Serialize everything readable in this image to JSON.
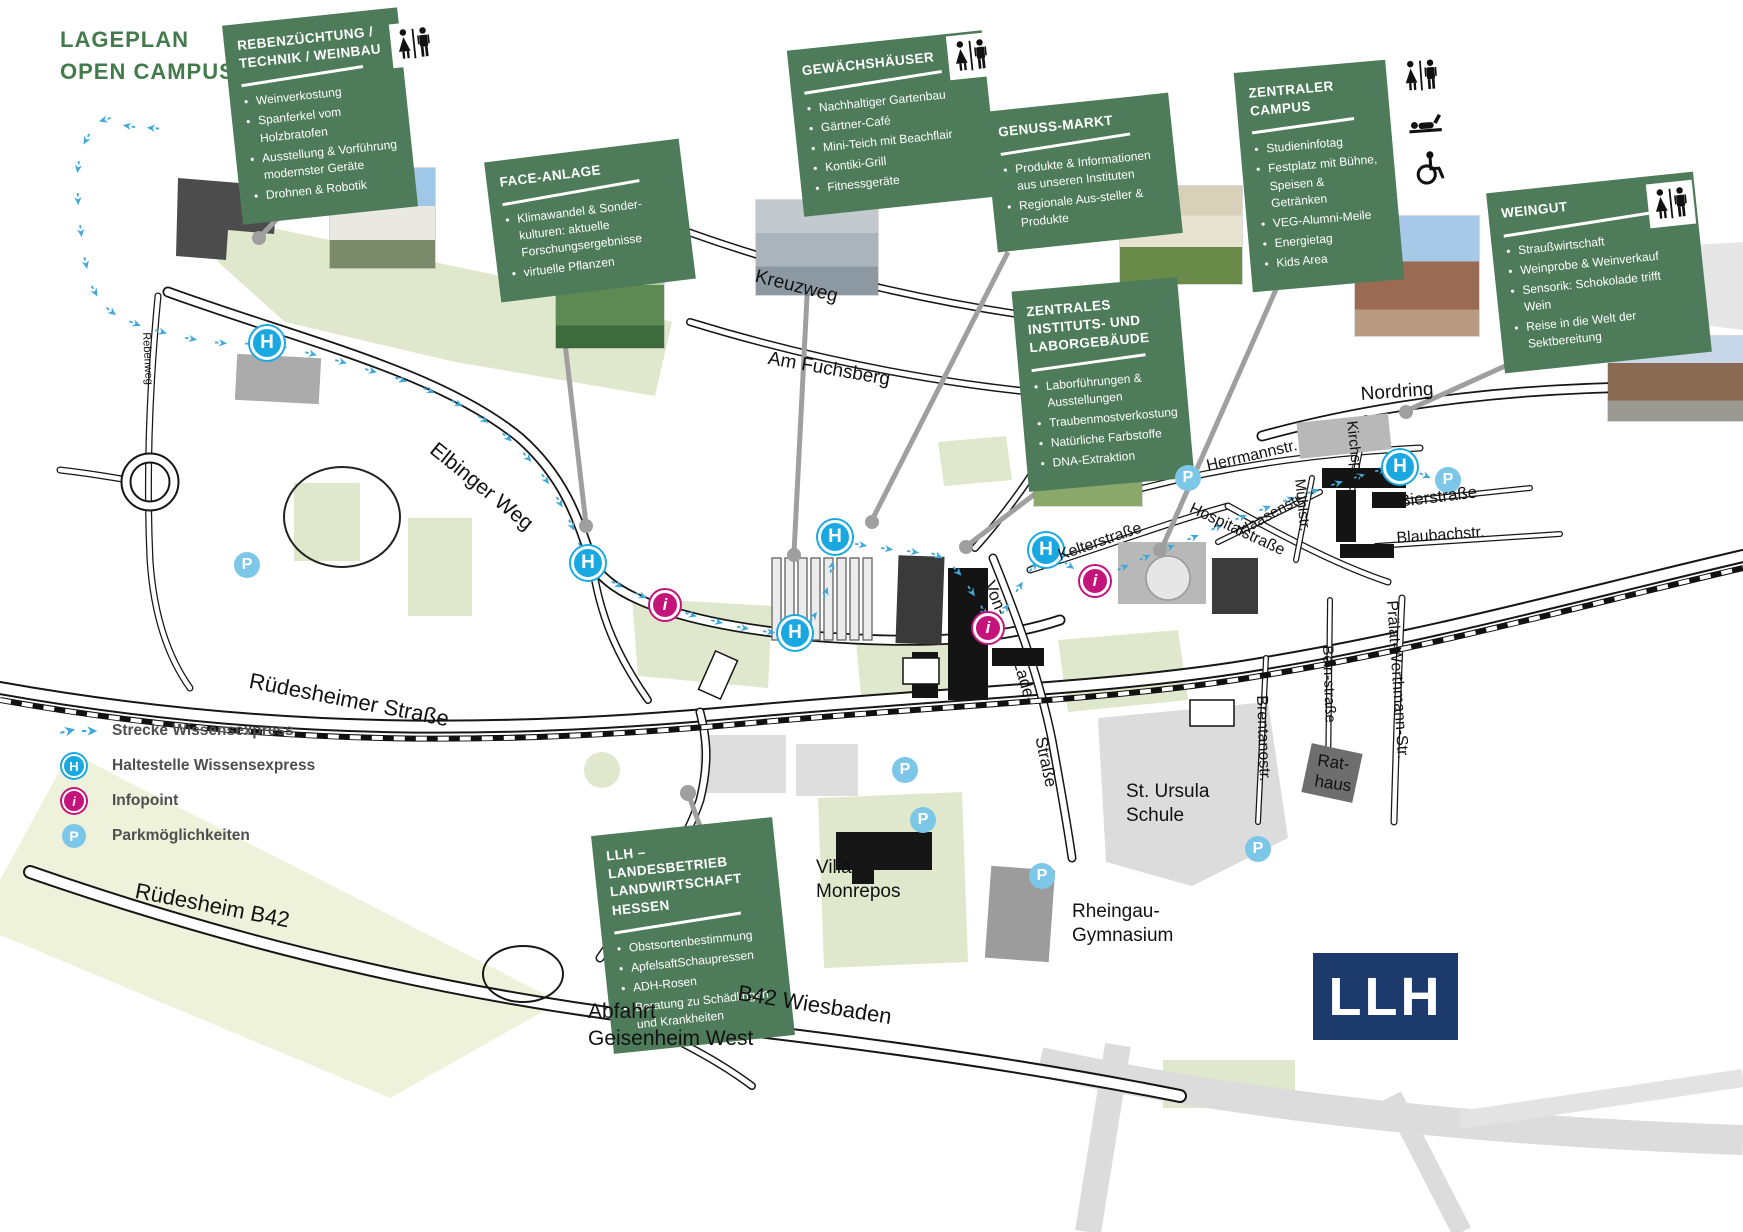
{
  "header": {
    "title_line1": "LAGEPLAN",
    "title_line2": "OPEN CAMPUS"
  },
  "boxes": [
    {
      "id": "rebenzuechtung",
      "title": "REBENZÜCHTUNG / TECHNIK / WEINBAU",
      "bullets": [
        "Weinverkostung",
        "Spanferkel vom Holzbratofen",
        "Ausstellung & Vorführung modernster Geräte",
        "Drohnen & Robotik"
      ],
      "facility_icons": [
        "wc"
      ]
    },
    {
      "id": "face-anlage",
      "title": "FACE-ANLAGE",
      "bullets": [
        "Klimawandel & Sonder-kulturen: aktuelle Forschungsergebnisse",
        "virtuelle Pflanzen"
      ],
      "facility_icons": []
    },
    {
      "id": "gewaechshaeuser",
      "title": "GEWÄCHSHÄUSER",
      "bullets": [
        "Nachhaltiger Gartenbau",
        "Gärtner-Café",
        "Mini-Teich mit Beachflair",
        "Kontiki-Grill",
        "Fitnessgeräte"
      ],
      "facility_icons": [
        "wc"
      ]
    },
    {
      "id": "genuss-markt",
      "title": "GENUSS-MARKT",
      "bullets": [
        "Produkte & Informationen aus unseren Instituten",
        "Regionale Aus-steller & Produkte"
      ],
      "facility_icons": []
    },
    {
      "id": "zentraler-campus",
      "title": "ZENTRALER CAMPUS",
      "bullets": [
        "Studieninfotag",
        "Festplatz mit Bühne, Speisen & Getränken",
        "VEG-Alumni-Meile",
        "Energietag",
        "Kids Area"
      ],
      "facility_icons": [
        "wc",
        "baby-changing",
        "wheelchair"
      ]
    },
    {
      "id": "zentrales-instituts-laborgebaeude",
      "title": "ZENTRALES INSTITUTS- UND LABORGEBÄUDE",
      "bullets": [
        "Laborführungen & Ausstellungen",
        "Traubenmostverkostung",
        "Natürliche Farbstoffe",
        "DNA-Extraktion"
      ],
      "facility_icons": []
    },
    {
      "id": "weingut",
      "title": "WEINGUT",
      "bullets": [
        "Straußwirtschaft",
        "Weinprobe & Weinverkauf",
        "Sensorik: Schokolade trifft Wein",
        "Reise in die Welt der Sektbereitung"
      ],
      "facility_icons": [
        "wc"
      ]
    },
    {
      "id": "llh",
      "title": "LLH – LANDESBETRIEB LANDWIRTSCHAFT HESSEN",
      "bullets": [
        "Obstsortenbestimmung",
        "ApfelsaftSchaupressen",
        "ADH-Rosen",
        "Beratung zu Schädlingen und Krankheiten"
      ],
      "facility_icons": []
    }
  ],
  "legend": {
    "items": [
      {
        "icon": "route-arrows",
        "label": "Strecke Wissensexpress"
      },
      {
        "icon": "stop",
        "label": "Haltestelle Wissensexpress"
      },
      {
        "icon": "infopoint",
        "label": "Infopoint"
      },
      {
        "icon": "parking",
        "label": "Parkmöglichkeiten"
      }
    ]
  },
  "markers": {
    "stop_letter": "H",
    "infopoint_letter": "i",
    "parking_letter": "P"
  },
  "streets": {
    "elbinger_weg": "Elbinger Weg",
    "kreuzweg": "Kreuzweg",
    "am_fuchsberg": "Am Fuchsberg",
    "ruedesheimer_strasse": "Rüdesheimer Straße",
    "ruedesheim_b42": "Rüdesheim  B42",
    "b42_wiesbaden": "B42 Wiesbaden",
    "abfahrt_geisenheim_west": "Abfahrt\nGeisenheim West",
    "nordring": "Nordring",
    "herrmannstr": "Herrmannstr.",
    "haasenstr": "Haasenstr.",
    "kelterstrasse": "Kelterstraße",
    "hospitalstrasse": "Hospitalstraße",
    "muehlstr": "Mühlstr.",
    "kirchspiel": "Kirchspiel",
    "bierstrasse": "Bierstraße",
    "blaubachstr": "Blaubachstr.",
    "praelat_werthmann_str": "Prälat-Werthmann-Str.",
    "bein_strasse": "Bein-straße",
    "brentanostr": "Brentanostr.",
    "von_lade": [
      "Von-",
      "Lade-",
      "Straße"
    ],
    "rebenweg": "Rebenweg"
  },
  "places": {
    "st_ursula": "St. Ursula\nSchule",
    "villa_monrepos": "Villa\nMonrepos",
    "rheingau_gymnasium": "Rheingau-\nGymnasium",
    "rathaus": "Rat-\nhaus"
  },
  "logo": {
    "text": "LLH"
  },
  "colors": {
    "box_green": "#4e7c5a",
    "title_green": "#447b4c",
    "route_blue": "#3fa9dc",
    "stop_blue": "#1aa8e1",
    "infopoint_magenta": "#c4137b",
    "parking_blue": "#7cc7e8",
    "logo_navy": "#1d3a6d",
    "map_green": "#dfe8cc"
  }
}
